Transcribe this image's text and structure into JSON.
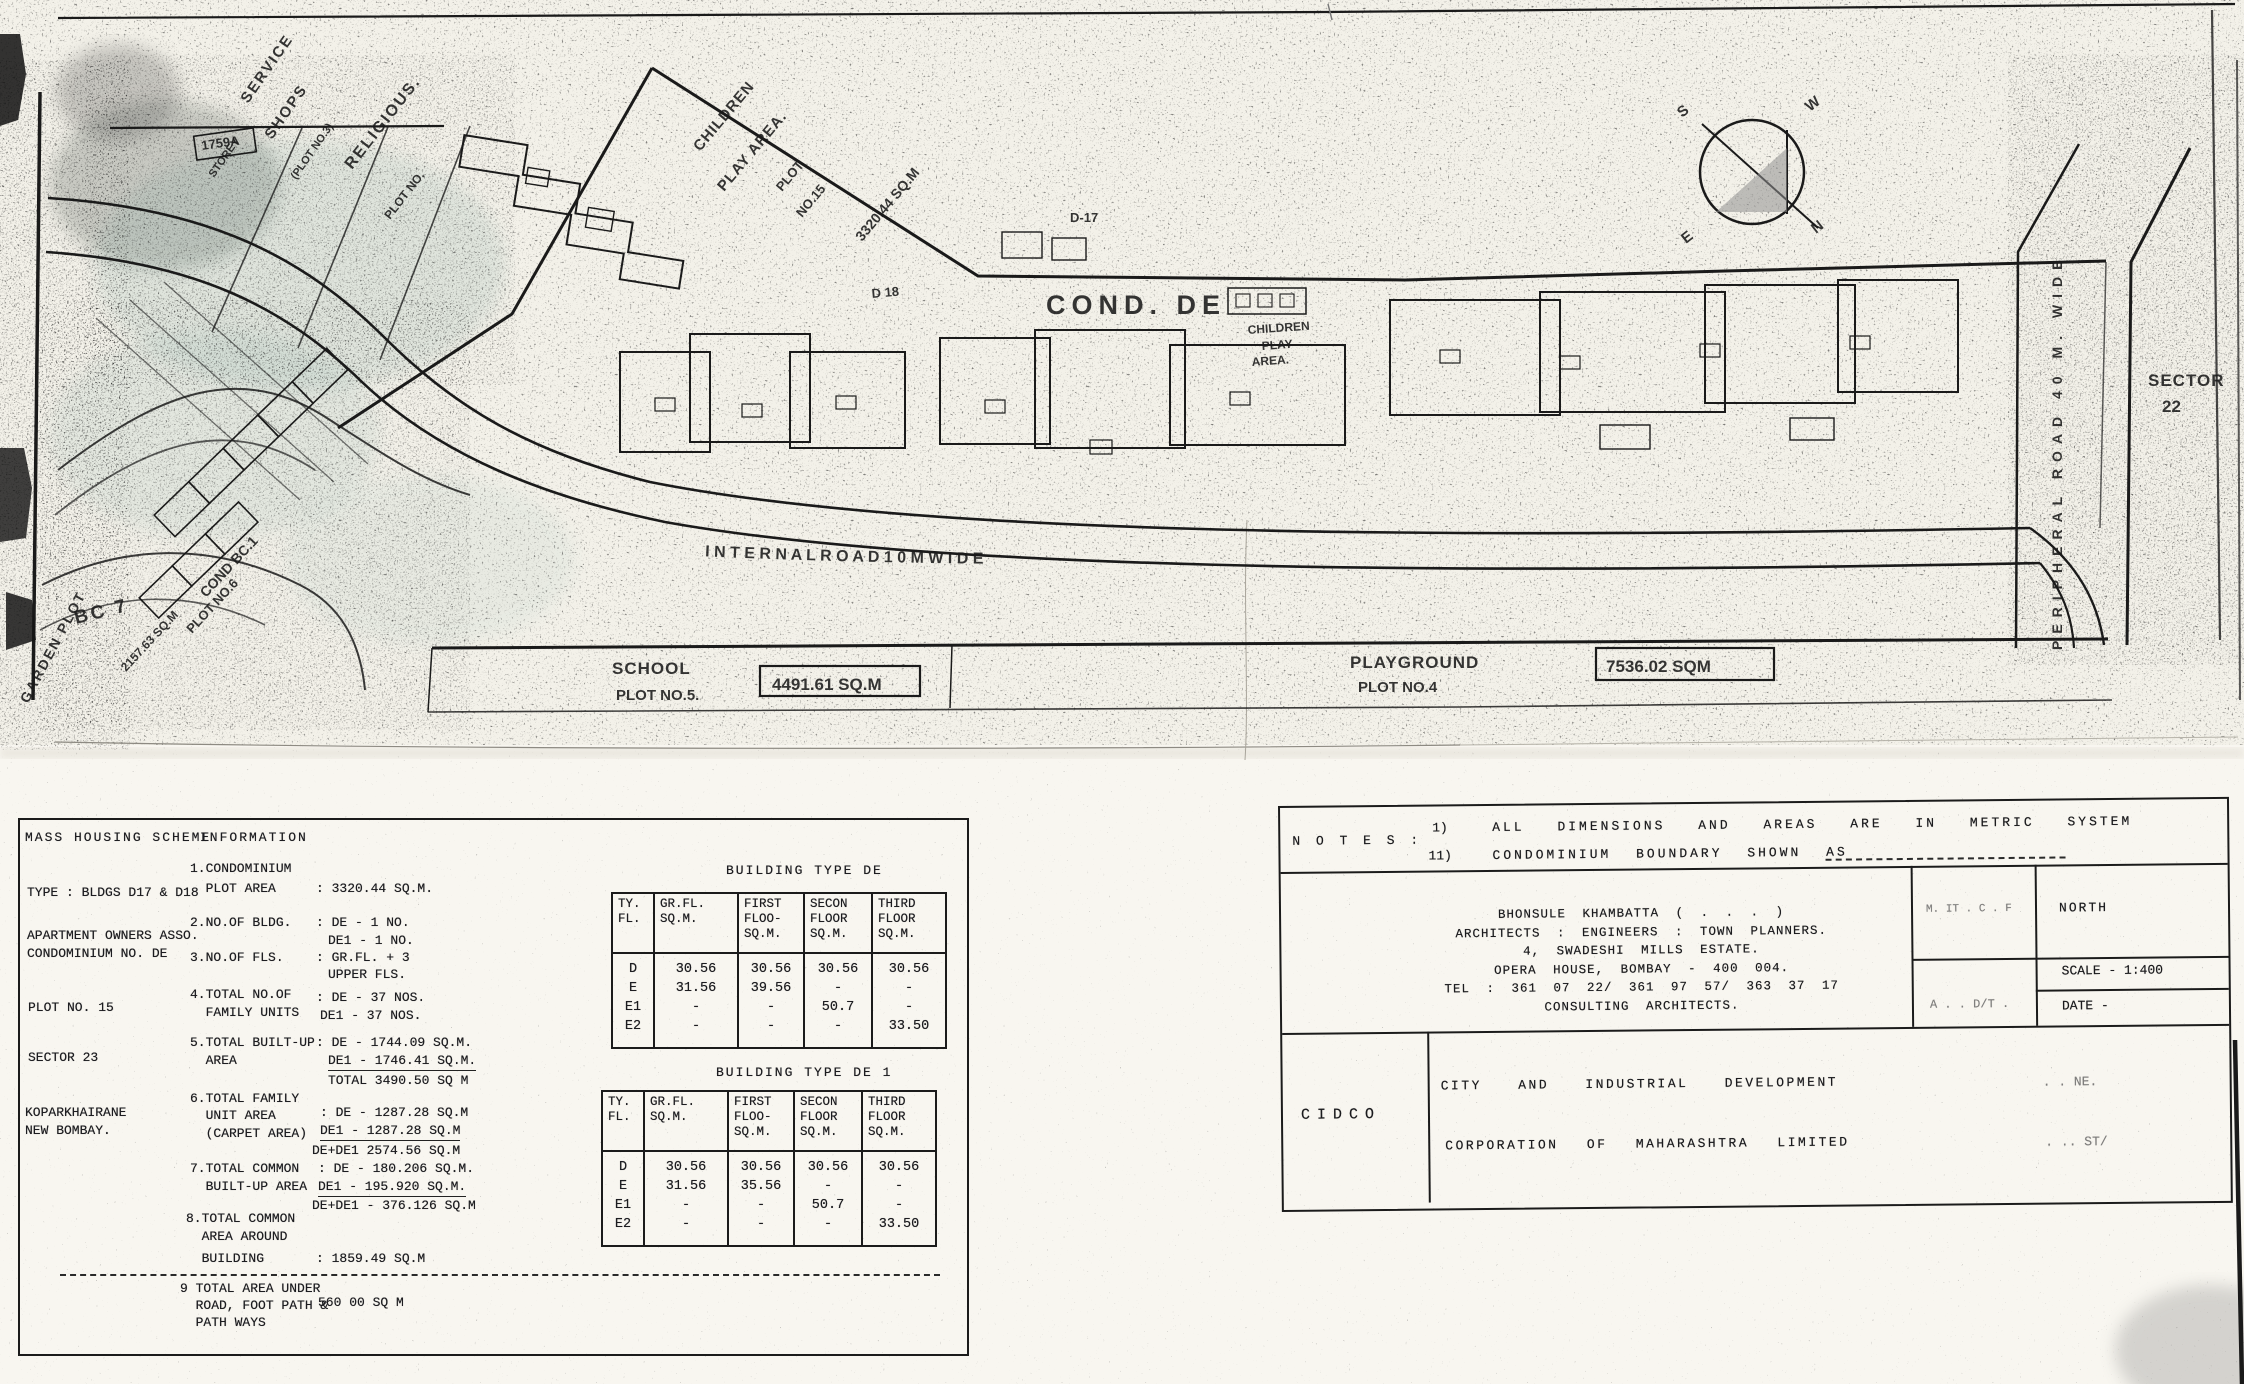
{
  "plan": {
    "service_line1": "SERVICE",
    "service_line2": "SHOPS",
    "service_line3": "(PLOT NO.3)",
    "service_line4": "STOREY",
    "tag_1759": "1759A",
    "religious_line1": "RELIGIOUS.",
    "religious_line2": "PLOT NO.",
    "children_top_line1": "CHILDREN",
    "children_top_line2": "PLAY AREA.",
    "plot15_line1": "PLOT",
    "plot15_line2": "NO.15",
    "plot15_area": "3320.44 SQ.M",
    "d18": "D 18",
    "d17": "D-17",
    "cond_de": "COND. DE",
    "children_small_line1": "CHILDREN",
    "children_small_line2": "PLAY",
    "children_small_line3": "AREA.",
    "bc7": "BC 7",
    "cond_bc1": "COND BC.1",
    "plot_no6": "PLOT NO.6",
    "bc1_area": "2157.63 SQ.M",
    "garden": "GARDEN PLOT",
    "internal_road": "I N T E R N A L   R O A D   1 0 M   W I D E",
    "school_line1": "SCHOOL",
    "school_line2": "PLOT NO.5.",
    "school_area": "4491.61 SQ.M",
    "playground_line1": "PLAYGROUND",
    "playground_line2": "PLOT NO.4",
    "playground_area": "7536.02 SQM",
    "sector_line1": "SECTOR",
    "sector_line2": "22",
    "peripheral_road": "PERIPHERAL ROAD 40 M. WIDE",
    "compass": {
      "n": "N",
      "e": "E",
      "s": "S",
      "w": "W"
    }
  },
  "info": {
    "title_left": "MASS HOUSING SCHEME",
    "title_right": "INFORMATION",
    "left": [
      "TYPE : BLDGS D17 & D18",
      "APARTMENT OWNERS ASSO.",
      "CONDOMINIUM NO. DE",
      "PLOT NO. 15",
      "SECTOR 23",
      "KOPARKHAIRANE",
      "NEW BOMBAY."
    ],
    "mid": [
      "1.CONDOMINIUM",
      "  PLOT AREA",
      "2.NO.OF BLDG.",
      "3.NO.OF FLS.",
      "4.TOTAL NO.OF",
      "  FAMILY UNITS",
      "5.TOTAL BUILT-UP",
      "  AREA",
      "6.TOTAL FAMILY",
      "  UNIT AREA",
      "  (CARPET AREA)",
      "7.TOTAL COMMON",
      "  BUILT-UP AREA",
      "8.TOTAL COMMON",
      "  AREA AROUND",
      "  BUILDING",
      "9 TOTAL AREA UNDER",
      "  ROAD, FOOT PATH &",
      "  PATH WAYS"
    ],
    "val": [
      ": 3320.44 SQ.M.",
      ": DE - 1 NO.",
      "DE1 - 1 NO.",
      ": GR.FL. + 3",
      "UPPER FLS.",
      ": DE - 37 NOS.",
      "DE1 - 37 NOS.",
      ": DE - 1744.09 SQ.M.",
      "DE1 - 1746.41 SQ.M.",
      "TOTAL 3490.50 SQ M",
      ": DE - 1287.28 SQ.M",
      "DE1 - 1287.28 SQ.M",
      "DE+DE1 2574.56 SQ.M",
      ": DE - 180.206 SQ.M.",
      "DE1 - 195.920 SQ.M.",
      "DE+DE1 - 376.126 SQ.M",
      ": 1859.49 SQ.M",
      "560 00 SQ M"
    ]
  },
  "bt1": {
    "title": "BUILDING TYPE DE",
    "headers": [
      "TY.\nFL.",
      "GR.FL.\nSQ.M.",
      "FIRST\nFLOO-\nSQ.M.",
      "SECON\nFLOOR\nSQ.M.",
      "THIRD\nFLOOR\nSQ.M."
    ],
    "cols": [
      "D\nE\nE1\nE2",
      "30.56\n31.56\n-\n-",
      "30.56\n39.56\n-\n-",
      "30.56\n-\n50.7\n-",
      "30.56\n-\n-\n33.50"
    ]
  },
  "bt2": {
    "title": "BUILDING TYPE DE 1",
    "headers": [
      "TY.\nFL.",
      "GR.FL.\nSQ.M.",
      "FIRST\nFLOO-\nSQ.M.",
      "SECON\nFLOOR\nSQ.M.",
      "THIRD\nFLOOR\nSQ.M."
    ],
    "cols": [
      "D\nE\nE1\nE2",
      "30.56\n31.56\n-\n-",
      "30.56\n35.56\n-\n-",
      "30.56\n-\n50.7\n-",
      "30.56\n-\n-\n33.50"
    ]
  },
  "tb": {
    "notes_label": "N O T E S :",
    "note1_num": "1)",
    "note1": "ALL DIMENSIONS AND AREAS ARE IN METRIC SYSTEM",
    "note2_num": "11)",
    "note2": "CONDOMINIUM BOUNDARY SHOWN AS",
    "arch": [
      "BHONSULE KHAMBATTA ( . . . )",
      "ARCHITECTS : ENGINEERS : TOWN PLANNERS.",
      "4, SWADESHI MILLS ESTATE.",
      "OPERA HOUSE, BOMBAY - 400 004.",
      "TEL : 361 07 22/ 361 97 57/ 363 37 17",
      "CONSULTING ARCHITECTS."
    ],
    "cell_a": "M. IT . C . F",
    "cell_north": "NORTH",
    "cell_appd": "A . . D/T .",
    "cell_scale": "SCALE - 1:400",
    "cell_date": "DATE -",
    "cidco": "CIDCO",
    "corp1": "CITY AND INDUSTRIAL DEVELOPMENT",
    "corp2": "CORPORATION OF MAHARASHTRA LIMITED",
    "frag1": ". . NE.",
    "frag2": ". .. ST/"
  }
}
